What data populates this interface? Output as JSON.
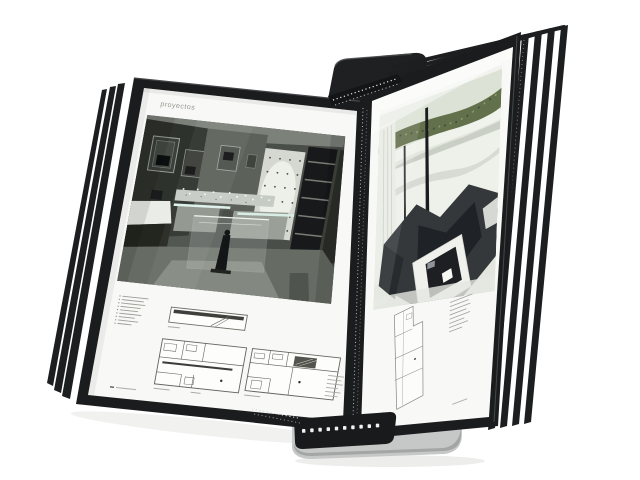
{
  "scene": {
    "type": "product-photograph",
    "subject": "Wall-mounted flip-panel reference display system with black-framed sleeves holding printed interior design project pages",
    "background": "#ffffff",
    "left_page": {
      "header": "proyectos"
    },
    "panels": {
      "left_stack_edges": 3,
      "right_stack_edges": 4
    },
    "colors": {
      "frame_black": "#1b1c1e",
      "page_white": "#f8f8f6",
      "bracket_gray": "#c6c8c7",
      "bracket_shade": "#9fa2a1",
      "insert_black": "#191a1c",
      "hedge_green": "#62704c",
      "photo_dark": "#34383b",
      "header_text": "#96968f",
      "plan_line": "#6e6e68"
    }
  }
}
